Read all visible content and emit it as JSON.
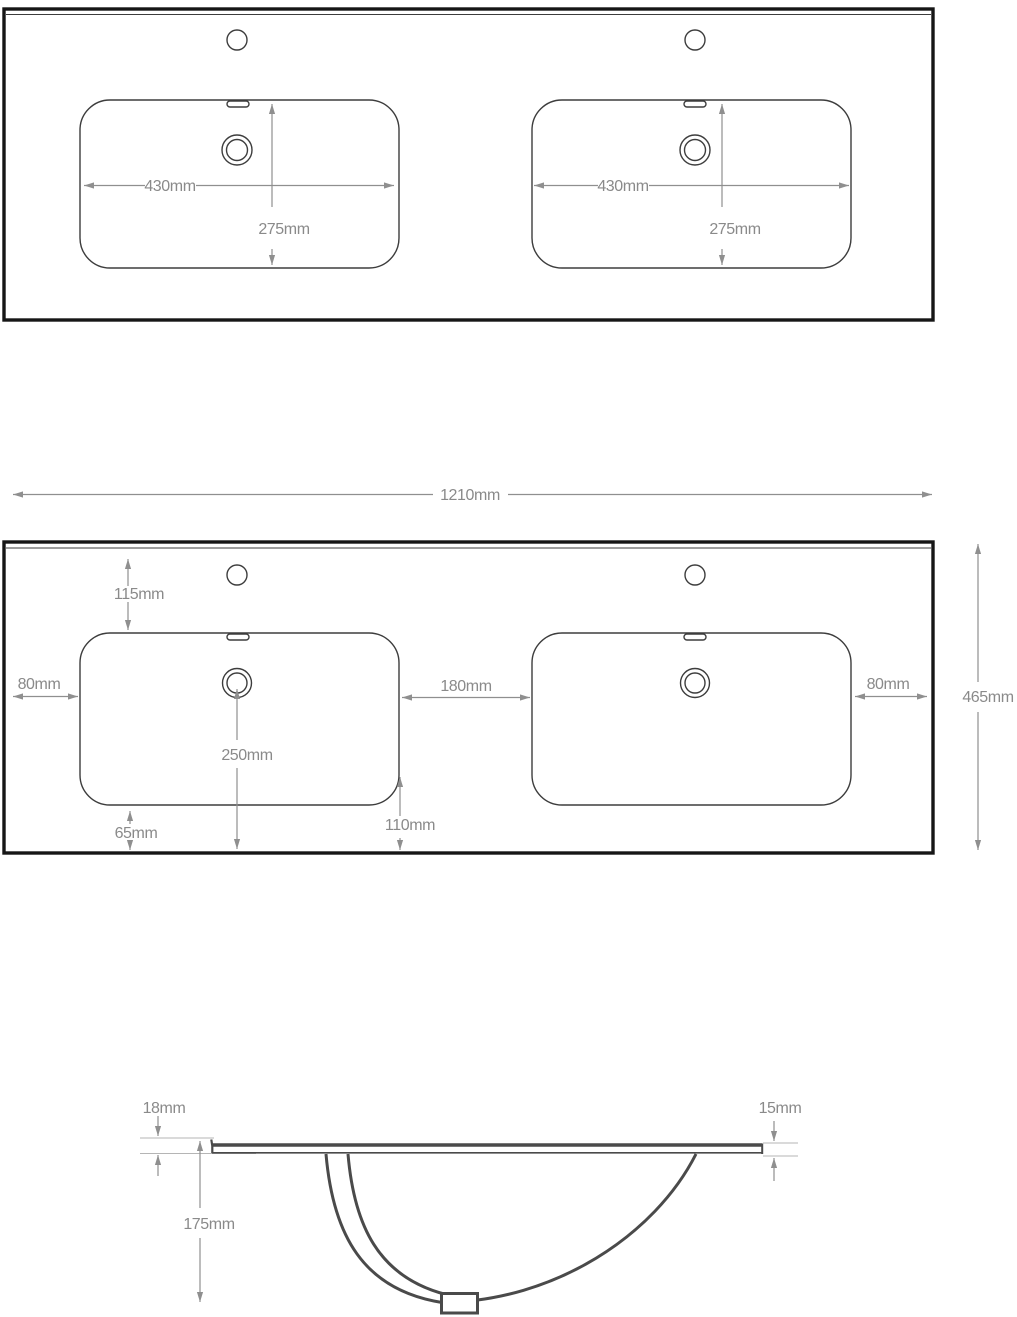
{
  "plan_view": {
    "left_basin": {
      "width": "430mm",
      "depth": "275mm"
    },
    "right_basin": {
      "width": "430mm",
      "depth": "275mm"
    }
  },
  "overall": {
    "width": "1210mm",
    "depth": "465mm"
  },
  "margin_view": {
    "tap_from_back": "115mm",
    "left_margin": "80mm",
    "between_basins": "180mm",
    "right_margin": "80mm",
    "drain_to_front": "250mm",
    "basin_to_front": "65mm",
    "corner_to_front": "110mm"
  },
  "section_view": {
    "left_edge_thickness": "18mm",
    "right_edge_thickness": "15mm",
    "bowl_depth": "175mm"
  },
  "colors": {
    "outline": "#161616",
    "detail_line": "#3d3d3d",
    "dimension_line": "#8f8f8f",
    "dimension_text": "#8a8a8a",
    "section_line": "#4a4a4a",
    "background": "#ffffff"
  }
}
